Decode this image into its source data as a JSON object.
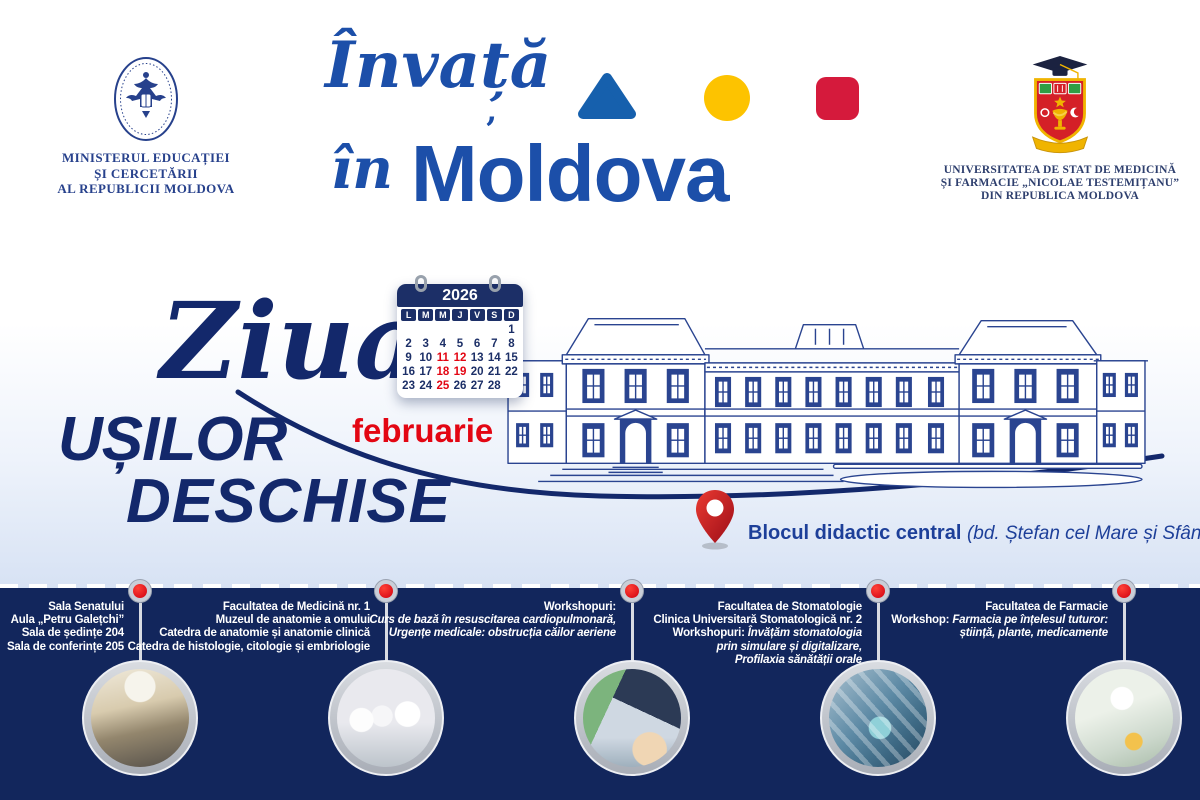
{
  "header": {
    "ministry": {
      "lines": [
        "MINISTERUL EDUCAȚIEI",
        "ȘI CERCETĂRII",
        "AL REPUBLICII MOLDOVA"
      ]
    },
    "brand": {
      "script_top": "Învață",
      "script_bottom": "în",
      "wordmark": "Moldova",
      "accent_mark": "’",
      "shapes": [
        {
          "name": "triangle",
          "color": "#1660ad"
        },
        {
          "name": "circle",
          "color": "#fdc300"
        },
        {
          "name": "square",
          "color": "#d51a3c"
        }
      ]
    },
    "university": {
      "lines": [
        "UNIVERSITATEA DE STAT DE MEDICINĂ",
        "ȘI FARMACIE „NICOLAE TESTEMIȚANU”",
        "DIN REPUBLICA MOLDOVA"
      ]
    }
  },
  "event": {
    "script_word": "Ziua",
    "title_line1": "UȘILOR",
    "title_line2": "DESCHISE",
    "month": "februarie",
    "calendar": {
      "year": "2026",
      "day_headers": [
        "L",
        "M",
        "M",
        "J",
        "V",
        "S",
        "D"
      ],
      "cells": [
        "",
        "",
        "",
        "",
        "",
        "",
        "1",
        "2",
        "3",
        "4",
        "5",
        "6",
        "7",
        "8",
        "9",
        "10",
        "11",
        "12",
        "13",
        "14",
        "15",
        "16",
        "17",
        "18",
        "19",
        "20",
        "21",
        "22",
        "23",
        "24",
        "25",
        "26",
        "27",
        "28",
        ""
      ],
      "highlighted_days": [
        "11",
        "12",
        "18",
        "19",
        "25"
      ]
    },
    "location": {
      "name": "Blocul didactic central",
      "address": "(bd. Ștefan cel Mare și Sfânt, 165)"
    }
  },
  "timeline": {
    "stops": [
      {
        "photo": "lecture-hall",
        "lines": [
          {
            "text": "Sala Senatului"
          },
          {
            "text": "Aula „Petru Galețchi”"
          },
          {
            "text": "Sala de ședințe 204"
          },
          {
            "text": "Sala de conferințe 205"
          }
        ]
      },
      {
        "photo": "anatomy-lab",
        "lines": [
          {
            "text": "Facultatea de Medicină nr. 1"
          },
          {
            "text": "Muzeul de anatomie a omului"
          },
          {
            "text": "Catedra de anatomie și anatomie clinică"
          },
          {
            "text": "Catedra de histologie, citologie și embriologie"
          }
        ]
      },
      {
        "photo": "cpr-workshop",
        "lines": [
          {
            "text": "Workshopuri:"
          },
          {
            "text": "Curs de bază în resuscitarea cardiopulmonară,",
            "italic": true
          },
          {
            "text": "Urgențe medicale: obstrucția căilor aeriene",
            "italic": true
          }
        ]
      },
      {
        "photo": "dental-clinic",
        "lines": [
          {
            "text": "Facultatea de Stomatologie"
          },
          {
            "text": "Clinica Universitară Stomatologică nr. 2"
          },
          {
            "prefix": "Workshopuri: ",
            "text": "Învățăm stomatologia",
            "italic": true
          },
          {
            "text": "prin simulare și digitalizare,",
            "italic": true
          },
          {
            "text": "Profilaxia sănătății orale",
            "italic": true
          }
        ]
      },
      {
        "photo": "pharmacy-workshop",
        "lines": [
          {
            "text": "Facultatea de Farmacie"
          },
          {
            "prefix": "Workshop: ",
            "text": "Farmacia pe înțelesul tuturor:",
            "italic": true
          },
          {
            "text": "știință, plante, medicamente",
            "italic": true
          }
        ]
      }
    ]
  },
  "colors": {
    "brand_blue": "#1c4fa9",
    "navy": "#13286b",
    "bottom_band_navy": "#12265c",
    "accent_red": "#e30613",
    "accent_yellow": "#fdc300",
    "calendar_navy": "#1c2f67"
  }
}
